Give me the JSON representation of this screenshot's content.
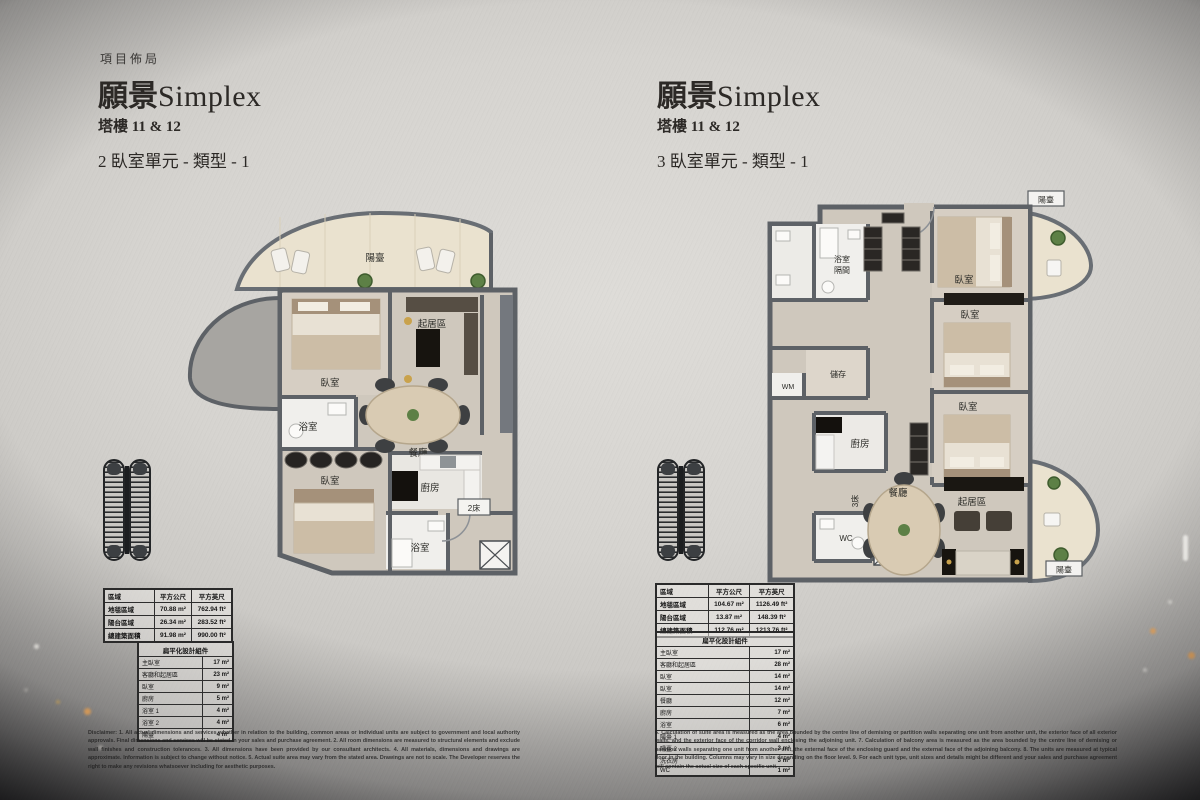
{
  "page": {
    "eyebrow": "項目佈局",
    "disclaimer_left": "Disclaimer: 1. All actual dimensions and services whether in relation to the building, common areas or individual units are subject to government and local authority approvals. Final dimensions and services will be stated in your sales and purchase agreement. 2. All room dimensions are measured to structural elements and exclude wall finishes and construction tolerances. 3. All dimensions have been provided by our consultant architects. 4. All materials, dimensions and drawings are approximate. Information is subject to change without notice. 5. Actual suite area may vary from the stated area. Drawings are not to scale. The Developer reserves the right to make any revisions whatsoever including for aesthetic purposes.",
    "disclaimer_right": "6. Calculation of suite area is measured as the area bounded by the centre line of demising or partition walls separating one unit from another unit, the exterior face of all exterior walls, and the exterior face of the corridor wall enclosing the adjoining unit. 7. Calculation of balcony area is measured as the area bounded by the centre line of demising or partition walls separating one unit from another unit, the external face of the enclosing guard and the external face of the adjoining balcony. 8. The units are measured at typical floor in the building. Columns may vary in size depending on the floor level. 9. For each unit type, unit sizes and details might be different and your sales and purchase agreement will contain the actual size of each specific unit.",
    "accent_colors": {
      "wall": "#5d6166",
      "balcony_floor": "#eae2cf",
      "carpet_floor": "#cfc8bd",
      "page_light": "#d6d4d0",
      "night": "#17171a"
    }
  },
  "left_unit": {
    "title_cjk": "願景",
    "title_latin": "Simplex",
    "tower": "塔樓 11 & 12",
    "unit_type": "2 臥室單元 - 類型 - 1",
    "plan_labels": {
      "balcony": "陽臺",
      "bedroom_1": "臥室",
      "living": "起居區",
      "bath_1": "浴室",
      "dining": "餐廳",
      "bedroom_2": "臥室",
      "kitchen": "廚房",
      "bath_2": "浴室",
      "beds_tag": "2床"
    },
    "area_table": {
      "header": {
        "region": "區域",
        "sqm": "平方公尺",
        "sqft": "平方英尺"
      },
      "rows": [
        {
          "label": "地毯區域",
          "sqm": "70.88 m²",
          "sqft": "762.94 ft²"
        },
        {
          "label": "陽台區域",
          "sqm": "26.34 m²",
          "sqft": "283.52 ft²"
        },
        {
          "label": "總建築面積",
          "sqm": "91.98 m²",
          "sqft": "990.00 ft²"
        }
      ]
    },
    "component_table": {
      "title": "扁平化設計組件",
      "rows": [
        {
          "label": "主臥室",
          "value": "17 m²"
        },
        {
          "label": "客廳和起居區",
          "value": "23 m²"
        },
        {
          "label": "臥室",
          "value": "9 m²"
        },
        {
          "label": "廚房",
          "value": "5 m²"
        },
        {
          "label": "浴室 1",
          "value": "4 m²"
        },
        {
          "label": "浴室 2",
          "value": "4 m²"
        },
        {
          "label": "陽臺",
          "value": "4 m²"
        }
      ]
    }
  },
  "right_unit": {
    "title_cjk": "願景",
    "title_latin": "Simplex",
    "tower": "塔樓 11 & 12",
    "unit_type": "3 臥室單元 - 類型 - 1",
    "plan_labels": {
      "balcony_top": "陽臺",
      "balcony_bottom": "陽臺",
      "bath_line1": "浴室",
      "bath_line2": "隔間",
      "bedroom_1": "臥室",
      "bedroom_2": "臥室",
      "bedroom_3": "臥室",
      "wm": "WM",
      "storage": "儲存",
      "kitchen": "廚房",
      "dining": "餐廳",
      "living": "起居區",
      "wc": "WC",
      "beds_tag": "3床"
    },
    "area_table": {
      "header": {
        "region": "區域",
        "sqm": "平方公尺",
        "sqft": "平方英尺"
      },
      "rows": [
        {
          "label": "地毯區域",
          "sqm": "104.67 m²",
          "sqft": "1126.49 ft²"
        },
        {
          "label": "陽台區域",
          "sqm": "13.87 m²",
          "sqft": "148.39 ft²"
        },
        {
          "label": "總建築面積",
          "sqm": "112.76 m²",
          "sqft": "1213.76 ft²"
        }
      ]
    },
    "component_table": {
      "title": "扁平化設計組件",
      "rows": [
        {
          "label": "主臥室",
          "value": "17 m²"
        },
        {
          "label": "客廳和起居區",
          "value": "28 m²"
        },
        {
          "label": "臥室",
          "value": "14 m²"
        },
        {
          "label": "臥室",
          "value": "14 m²"
        },
        {
          "label": "餐廳",
          "value": "12 m²"
        },
        {
          "label": "廚房",
          "value": "7 m²"
        },
        {
          "label": "浴室",
          "value": "6 m²"
        },
        {
          "label": "陽臺 1",
          "value": "4 m²"
        },
        {
          "label": "陽臺 2",
          "value": "3 m²"
        },
        {
          "label": "洗衣房",
          "value": "3 m²"
        },
        {
          "label": "WC",
          "value": "1 m²"
        }
      ]
    }
  }
}
